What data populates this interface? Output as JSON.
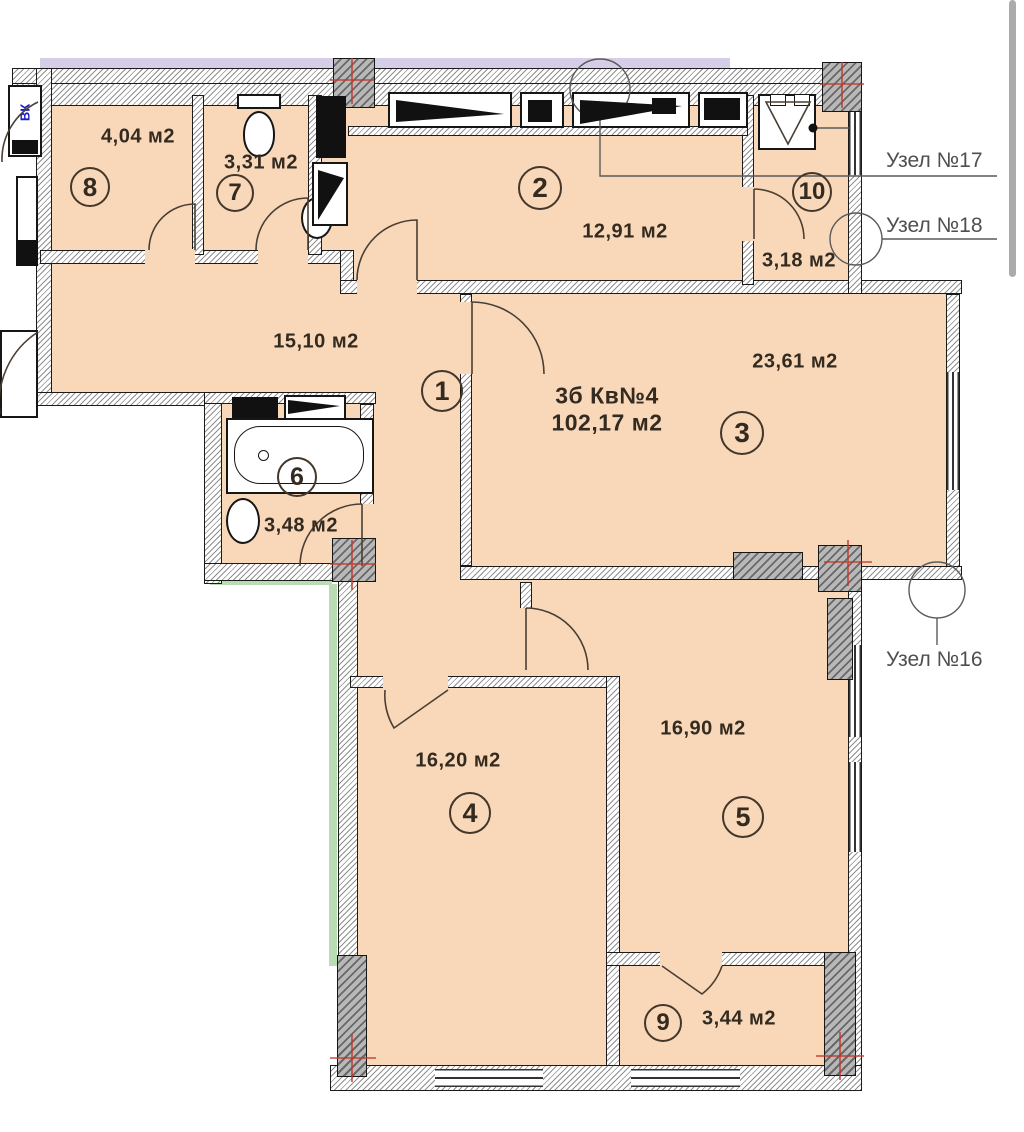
{
  "plan": {
    "apartment": {
      "type_label": "3б Кв№4",
      "area_label": "102,17 м2"
    },
    "rooms": [
      {
        "number": "1",
        "area": "15,10 м2"
      },
      {
        "number": "2",
        "area": "12,91 м2"
      },
      {
        "number": "3",
        "area": "23,61 м2"
      },
      {
        "number": "4",
        "area": "16,20 м2"
      },
      {
        "number": "5",
        "area": "16,90 м2"
      },
      {
        "number": "6",
        "area": "3,48 м2"
      },
      {
        "number": "7",
        "area": "3,31 м2"
      },
      {
        "number": "8",
        "area": "4,04 м2"
      },
      {
        "number": "9",
        "area": "3,44 м2"
      },
      {
        "number": "10",
        "area": "3,18 м2"
      }
    ],
    "nodes": {
      "n17": "Узел №17",
      "n18": "Узел №18",
      "n16": "Узел №16"
    },
    "shaft_label": "ВК",
    "colors": {
      "room_fill": "#f9d8ba",
      "wall_line": "#1b1b1b",
      "axis_red": "#c0392b",
      "balcony_green": "#b9dcb4",
      "top_strip": "#d6cde6",
      "node_text": "#4f4f4f",
      "shaft_text": "#1c1cc0"
    }
  }
}
